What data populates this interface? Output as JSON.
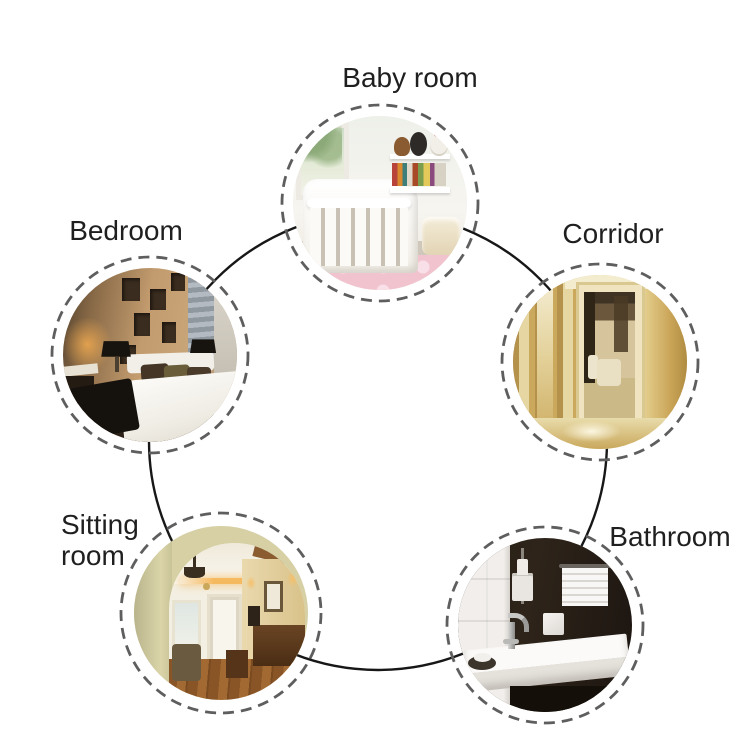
{
  "diagram": {
    "type": "circular-room-showcase",
    "background": "#ffffff",
    "connector_color": "#171717",
    "dashed_ring_color": "#5e5e5e",
    "label_color": "#1f1f1f"
  },
  "rooms": [
    {
      "id": "baby-room",
      "label": "Baby room",
      "position": "top",
      "photo_alt": "white nursery crib beside a window, bookshelf with plush toys and colorful books, pink rug with light dots"
    },
    {
      "id": "bedroom",
      "label": "Bedroom",
      "position": "upper-left",
      "photo_alt": "bedroom with tan paneled feature wall with dark recesses, white bed with dark pillows, black lamp shades and warm glow"
    },
    {
      "id": "corridor",
      "label": "Corridor",
      "position": "upper-right",
      "photo_alt": "warm golden hallway with paneled walls, open doorway into a room with dark curtains and glossy beige floor"
    },
    {
      "id": "sitting-room",
      "label": "Sitting room",
      "position": "lower-left",
      "photo_alt": "arched opening into a sitting room with cove lighting, chandelier, white door, dark wood furniture and wood plank floor"
    },
    {
      "id": "bathroom",
      "label": "Bathroom",
      "position": "lower-right",
      "photo_alt": "dark walled bathroom with white tiles, white basin with chrome faucet, wall dispenser and striped white towel"
    }
  ]
}
